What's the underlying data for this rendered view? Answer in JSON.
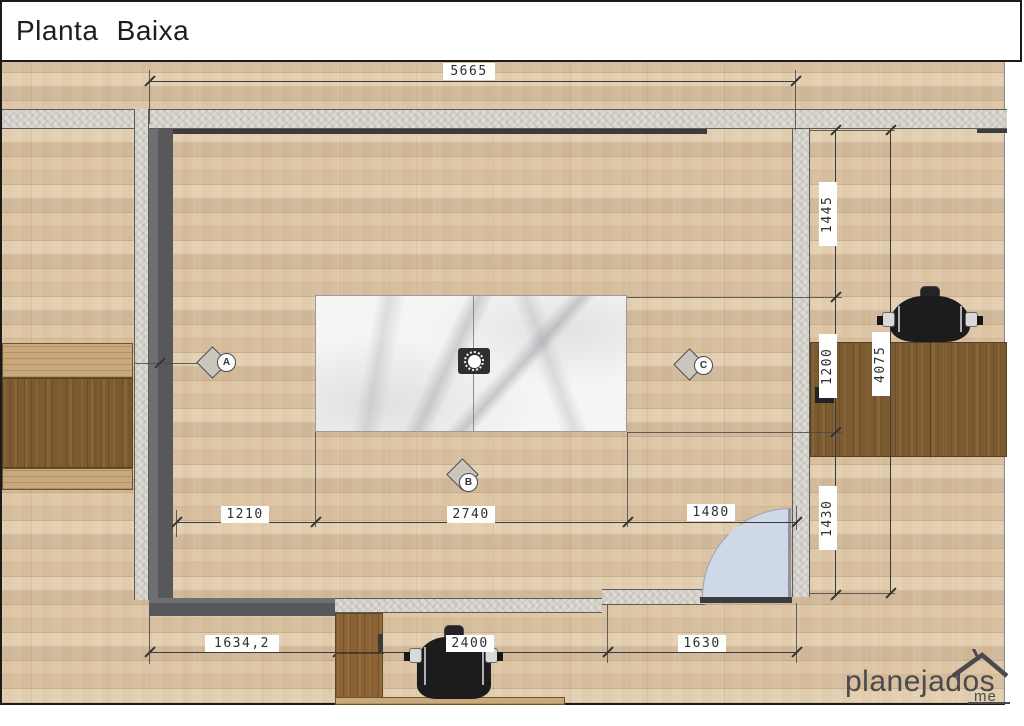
{
  "title_block": {
    "title": "Planta Baixa"
  },
  "dimensions": {
    "width_total": "5665",
    "right_seg_top": "1445",
    "right_seg_mid": "1200",
    "right_seg_bottom": "1430",
    "right_total": "4075",
    "mid_seg_left": "1210",
    "mid_seg_center": "2740",
    "mid_seg_right": "1480",
    "bottom_seg_left": "1634,2",
    "bottom_seg_center": "2400",
    "bottom_seg_right": "1630"
  },
  "section_markers": {
    "a": "A",
    "b": "B",
    "c": "C"
  },
  "watermark": {
    "brand": "planejados",
    "domain_suffix": "me"
  },
  "colors": {
    "floor_wood": "#dcc6a9",
    "concrete_wall": "#d7d5ce",
    "dark_wall": "#58585a",
    "marble": "#f5f5f4",
    "desk_wood": "#7d5b31",
    "cabinet_wood": "#8a6234",
    "counter_wood": "#c9a97b",
    "door_swing": "#cfd8e6",
    "dimension_line": "#3a3a3a",
    "chair_black": "#1c1c1e"
  }
}
